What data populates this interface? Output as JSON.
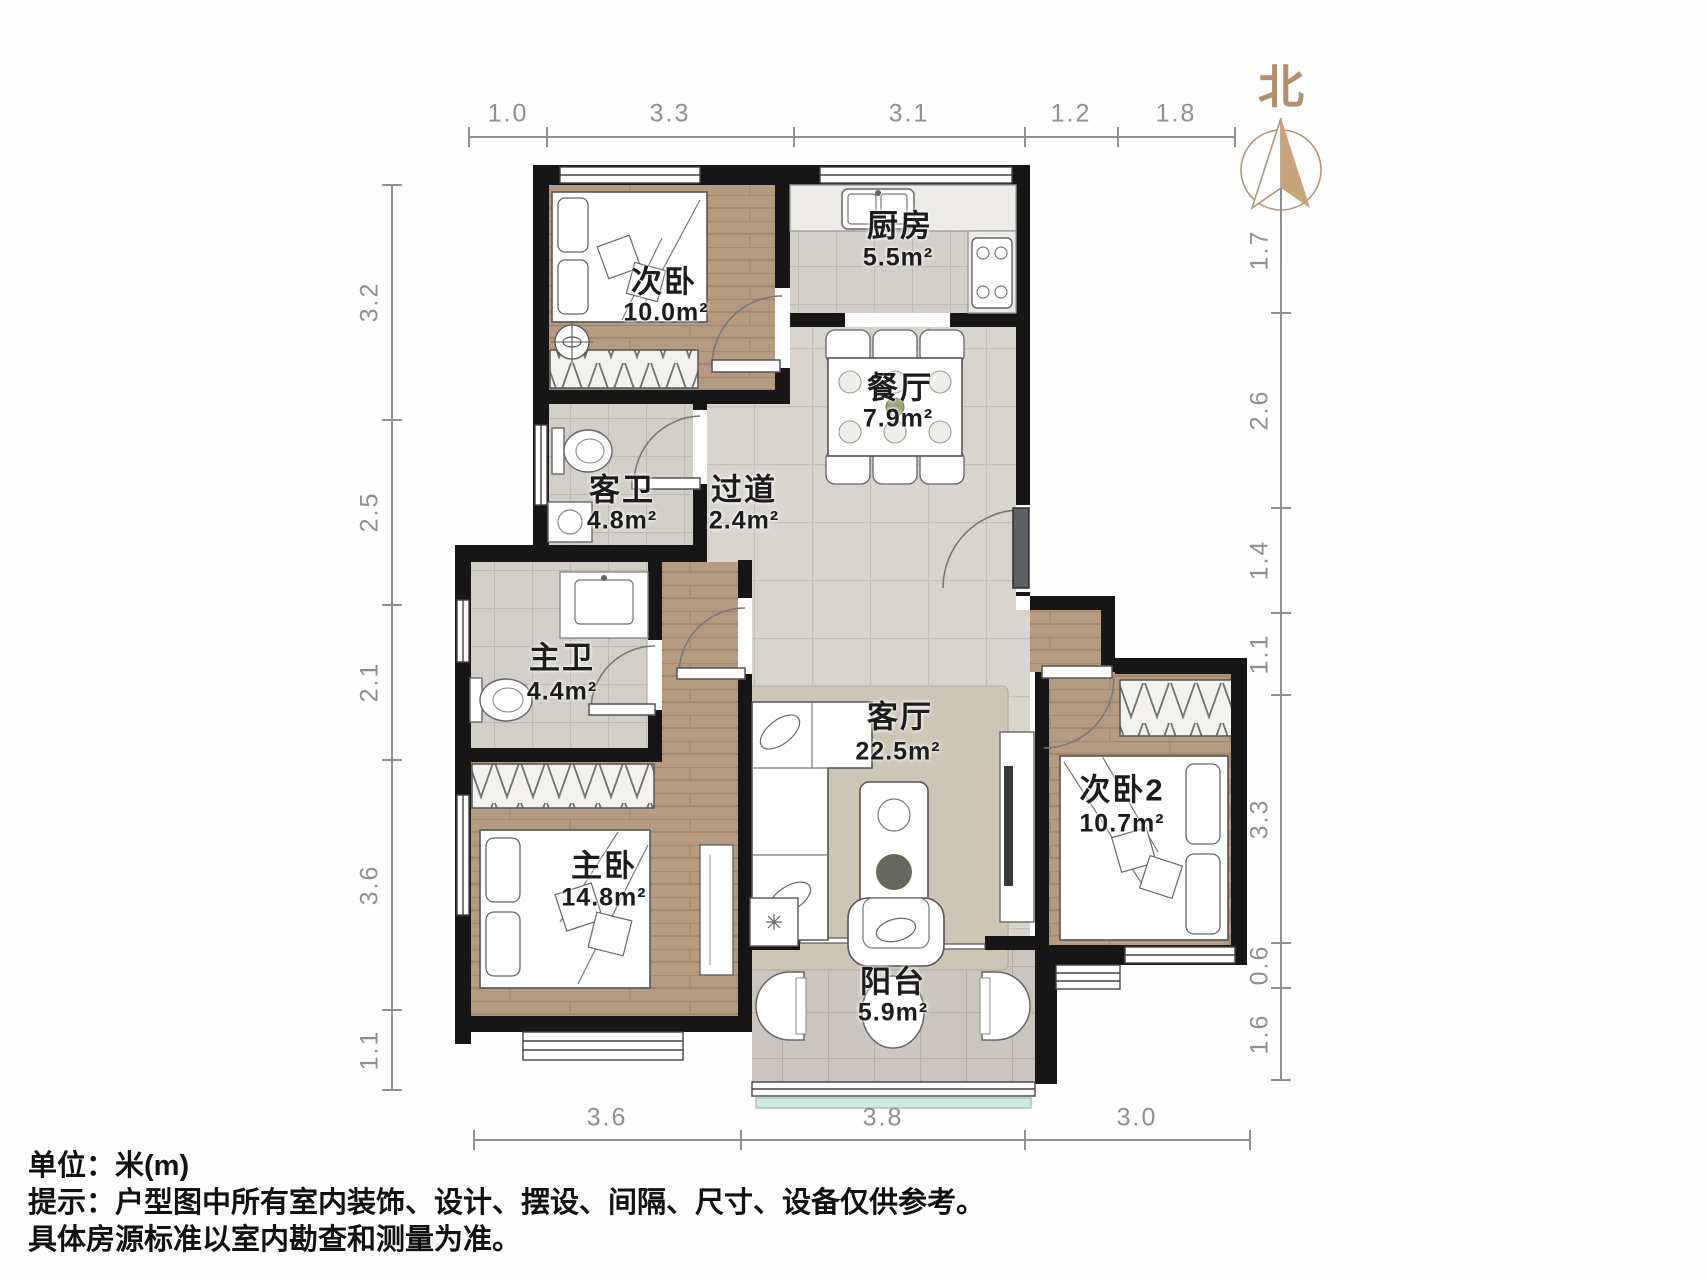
{
  "title": "户型图",
  "north_label": "北",
  "unit_note": "米(m)",
  "rooms": [
    {
      "id": "secondary-bedroom",
      "name": "次卧",
      "area": "10.0m²"
    },
    {
      "id": "kitchen",
      "name": "厨房",
      "area": "5.5m²"
    },
    {
      "id": "dining-room",
      "name": "餐厅",
      "area": "7.9m²"
    },
    {
      "id": "guest-bathroom",
      "name": "客卫",
      "area": "4.8m²"
    },
    {
      "id": "hallway",
      "name": "过道",
      "area": "2.4m²"
    },
    {
      "id": "master-bathroom",
      "name": "主卫",
      "area": "4.4m²"
    },
    {
      "id": "living-room",
      "name": "客厅",
      "area": "22.5m²"
    },
    {
      "id": "master-bedroom",
      "name": "主卧",
      "area": "14.8m²"
    },
    {
      "id": "secondary-bedroom-2",
      "name": "次卧2",
      "area": "10.7m²"
    },
    {
      "id": "balcony",
      "name": "阳台",
      "area": "5.9m²"
    }
  ],
  "dimensions": {
    "top": [
      "1.0",
      "3.3",
      "3.1",
      "1.2",
      "1.8"
    ],
    "left": [
      "3.2",
      "2.5",
      "2.1",
      "3.6",
      "1.1"
    ],
    "right": [
      "1.7",
      "2.6",
      "1.4",
      "1.1",
      "3.3",
      "0.6",
      "1.6"
    ],
    "bottom": [
      "3.6",
      "3.8",
      "3.0"
    ]
  },
  "footer": {
    "line1": "单位：米(m)",
    "line2": "提示：户型图中所有室内装饰、设计、摆设、间隔、尺寸、设备仅供参考。",
    "line3": "具体房源标准以室内勘查和测量为准。"
  },
  "colors": {
    "wall": "#161616",
    "wood_floor": "#b69b81",
    "tile_floor": "#d8d5cf",
    "north_accent": "#b3906c",
    "dimension_gray": "#8f8f8f",
    "balcony_glass_teal": "#cfe8e4"
  }
}
